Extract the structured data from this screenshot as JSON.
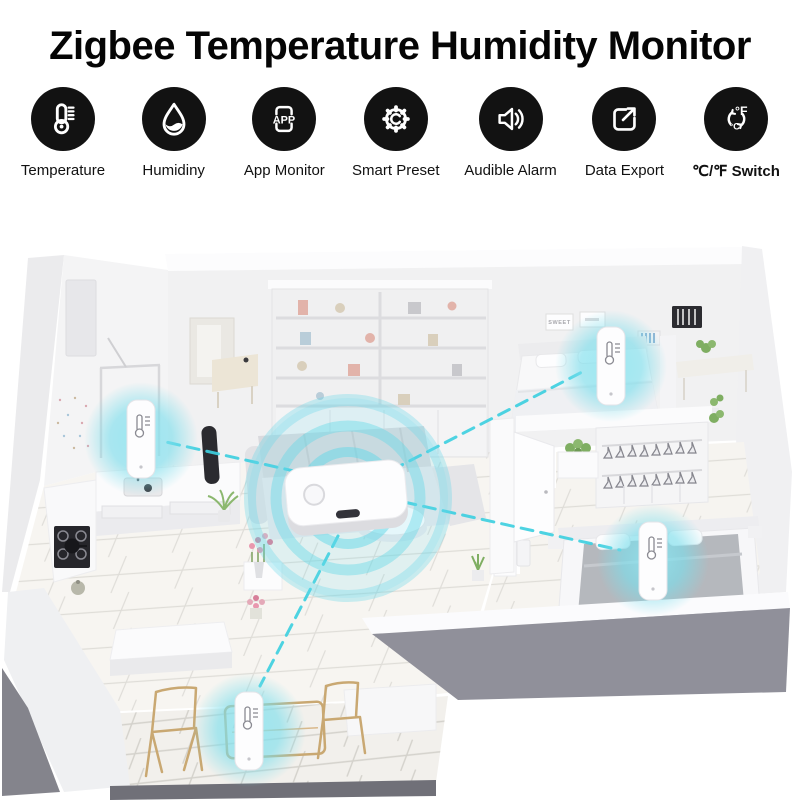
{
  "header": {
    "title": "Zigbee Temperature Humidity Monitor"
  },
  "features": [
    {
      "icon": "thermometer-icon",
      "label": "Temperature"
    },
    {
      "icon": "water-drop-icon",
      "label": "Humidiny"
    },
    {
      "icon": "app-monitor-icon",
      "label": "App Monitor",
      "badge_text": "APP"
    },
    {
      "icon": "gear-icon",
      "label": "Smart Preset"
    },
    {
      "icon": "speaker-icon",
      "label": "Audible Alarm"
    },
    {
      "icon": "export-icon",
      "label": "Data Export"
    },
    {
      "icon": "temp-unit-switch-icon",
      "label": "℃/℉ Switch",
      "glyph_top": "°F",
      "glyph_bottom": "°C"
    }
  ],
  "floorplan": {
    "wall_art_text": "SWEET",
    "hub_count": 1,
    "sensor_count": 4,
    "colors": {
      "signal_cyan": "#3ECFE0",
      "glow_cyan": "#7FE0EE",
      "outer_wall_gray": "#90909A"
    }
  }
}
